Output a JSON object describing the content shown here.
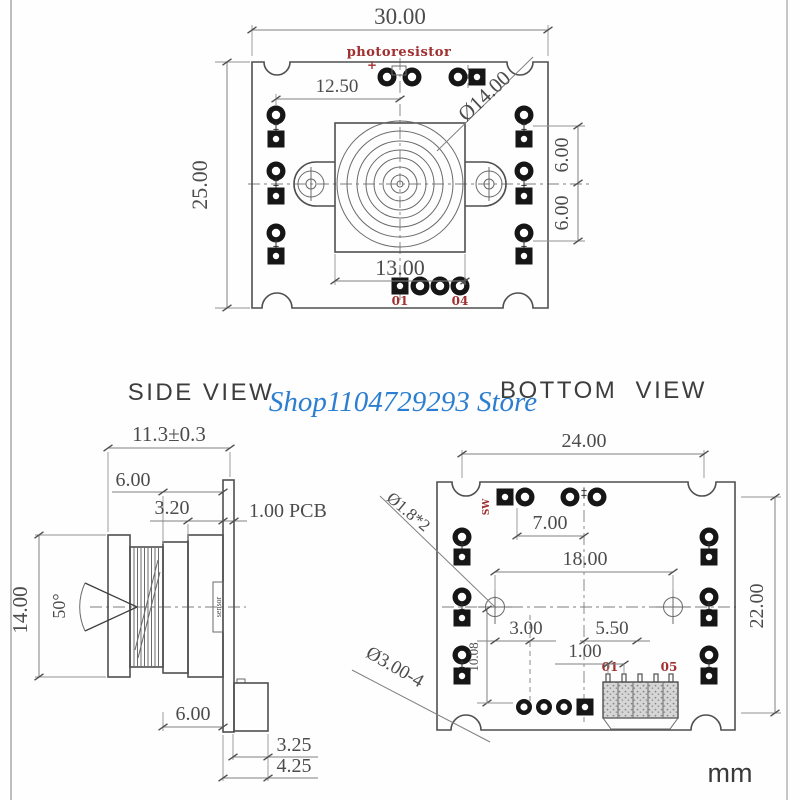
{
  "page": {
    "watermark": "Shop1104729293 Store",
    "unit": "mm",
    "titles": {
      "side": "SIDE VIEW",
      "bottom": "BOTTOM  VIEW"
    }
  },
  "colors": {
    "drawing_line": "#4f4f4f",
    "dimension_text": "#4c4c4c",
    "annotation_red": "#a12f2f",
    "watermark_blue": "#2b7ed0"
  },
  "top_view": {
    "dims": {
      "board_width": "30.00",
      "board_height": "25.00",
      "lens_center_offset": "12.50",
      "lens_diameter": "Ø14.00",
      "lens_holder_width": "13.00",
      "pad_pitch_upper": "6.00",
      "pad_pitch_lower": "6.00"
    },
    "labels": {
      "photoresistor": "photoresistor",
      "plus": "+",
      "pin_first": "01",
      "pin_last": "04"
    }
  },
  "side_view": {
    "dims": {
      "total_depth": "11.3±0.3",
      "lens_front_len": "6.00",
      "holder_len": "3.20",
      "pcb_thickness": "1.00 PCB",
      "lens_outer_dia": "14.00",
      "field_of_view": "50°",
      "connector_height": "6.00",
      "connector_width": "3.25",
      "connector_total": "4.25"
    },
    "labels": {
      "sensor": "sensor"
    }
  },
  "bottom_view": {
    "dims": {
      "board_width": "24.00",
      "pad_offset": "7.00",
      "hole_pitch": "18.00",
      "board_height": "22.00",
      "hole_diameter": "Ø1.8*2",
      "offset_a": "3.00",
      "offset_b": "5.50",
      "pin_pitch": "1.00",
      "offset_c": "10.08",
      "notch_diameter": "Ø3.00-4"
    },
    "labels": {
      "sw": "SW",
      "pin_first": "01",
      "pin_last": "05"
    }
  }
}
